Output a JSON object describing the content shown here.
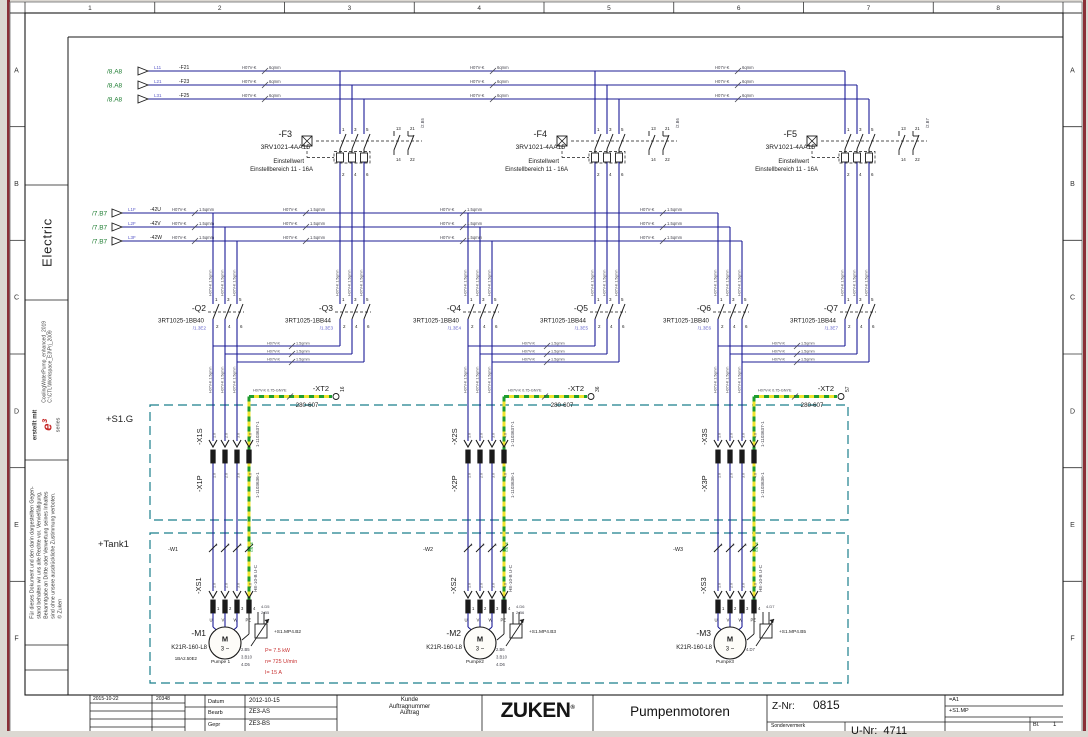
{
  "frame": {
    "columns": [
      "1",
      "2",
      "3",
      "4",
      "5",
      "6",
      "7",
      "8"
    ],
    "rows": [
      "A",
      "B",
      "C",
      "D",
      "E",
      "F"
    ]
  },
  "sidebar": {
    "discipline": "Electric",
    "created_with": "erstellt mit",
    "logo_text": "e³",
    "logo_sub": "series",
    "project_name": "CoolingWaterPump_enhanced_2019",
    "project_path": "C:\\CTL\\Workspace_E3\\Prj_2009",
    "disclaimer_lines": [
      "Für dieses Dokument und den darin dargestellten Gegen-",
      "stand behalten wir uns alle Rechte vor. Vervielfältigung,",
      "Bekanntgabe an Dritte oder Verwertung seines Inhaltes",
      "sind ohne unsere ausdrückliche Zustimmung verboten.",
      "© Zuken"
    ]
  },
  "colors": {
    "wire": "#1c1c96",
    "wire_label": "#44444e",
    "green_ref": "#1e7d32",
    "blue_label": "#5a5ac8",
    "gnye_green": "#1f9d2f",
    "gnye_yellow": "#f0e32e",
    "region": "#1b7f8c",
    "red": "#c83232",
    "black": "#1a1a1a",
    "maroon_edge": "#8a3038"
  },
  "feeders": {
    "lines": [
      {
        "ref": "/8.A8",
        "wire": "L11",
        "device": "-F21",
        "gauge": "H07V-K 6qmm"
      },
      {
        "ref": "/8.A8",
        "wire": "L21",
        "device": "-F23",
        "gauge": "H07V-K 6qmm"
      },
      {
        "ref": "/8.A8",
        "wire": "L31",
        "device": "-F25",
        "gauge": "H07V-K 6qmm"
      }
    ]
  },
  "control_lines": [
    {
      "ref": "/7.B7",
      "wire": "L1F",
      "device": "-42U",
      "gauge": "H07V-K 1.5qmm"
    },
    {
      "ref": "/7.B7",
      "wire": "L2F",
      "device": "-42V",
      "gauge": "H07V-K 1.5qmm"
    },
    {
      "ref": "/7.B7",
      "wire": "L3F",
      "device": "-42W",
      "gauge": "H07V-K 1.5qmm"
    }
  ],
  "regions": [
    {
      "label": "+S1.G"
    },
    {
      "label": "+Tank1"
    }
  ],
  "groups": [
    {
      "breaker": {
        "name": "-F3",
        "type": "3RV1021-4AA15",
        "note1": "Einstellwert",
        "note2": "Einstellbereich 11 - 16A",
        "pins_top": [
          "1",
          "3",
          "5"
        ],
        "pins_bottom": [
          "2",
          "4",
          "6"
        ],
        "aux_pins_top": [
          "13",
          "21"
        ],
        "aux_pins_bottom": [
          "14",
          "22"
        ],
        "aux_ref": "/2.B5"
      },
      "contactor_left": {
        "name": "-Q2",
        "type": "3RT1025-1BB40",
        "ref": "/1.3E2",
        "pins_top": [
          "1",
          "3",
          "5"
        ],
        "pins_bottom": [
          "2",
          "4",
          "6"
        ]
      },
      "contactor_right": {
        "name": "-Q3",
        "type": "3RT1025-1BB44",
        "ref": "/1.3E3",
        "pins_top": [
          "1",
          "3",
          "5"
        ],
        "pins_bottom": [
          "2",
          "4",
          "6"
        ]
      },
      "drop_gauge": "H07V-K 1.5qmm",
      "pe_terminal": {
        "name": "-XT2",
        "pin": "16",
        "part": "280-607",
        "wire_label": "H07V-K 0.75-GNYE"
      },
      "connector_s": {
        "name": "-X1S",
        "part": "1-1103637-1",
        "pins": [
          "1.0",
          "2.0",
          "3.0",
          "4.0"
        ]
      },
      "connector_p": {
        "name": "-X1P",
        "part": "1-1103636-1",
        "pins": [
          "1.0",
          "2.0",
          "3.0",
          "4.0"
        ]
      },
      "cable": {
        "name": "-W1",
        "cores": [
          "1",
          "2",
          "3",
          "GNYE"
        ]
      },
      "socket": {
        "name": "-XS1",
        "type": "HE-10-B U-C",
        "pins": [
          "1",
          "2",
          "3",
          "4"
        ],
        "terminals": [
          "U",
          "V",
          "W",
          "PE"
        ],
        "marks": [
          "1.0",
          "2.0",
          "3.0",
          "4.0"
        ]
      },
      "motor": {
        "name": "-M1",
        "symbol": "M",
        "phase": "3 ~",
        "type": "K21R-160-L8",
        "code": "1BA2.50E2",
        "label": "Pumpe 1",
        "refs": [
          "2.B5",
          "3.B10",
          "4.D5"
        ],
        "specs": [
          "P= 7.5 kW",
          "n= 725 U/min",
          "I= 15 A"
        ]
      },
      "sensor": {
        "name": "+S1.MP4.B2",
        "refs": [
          "4.D5",
          "2.B5"
        ]
      }
    },
    {
      "breaker": {
        "name": "-F4",
        "type": "3RV1021-4AA15",
        "note1": "Einstellwert",
        "note2": "Einstellbereich 11 - 16A",
        "pins_top": [
          "1",
          "3",
          "5"
        ],
        "pins_bottom": [
          "2",
          "4",
          "6"
        ],
        "aux_pins_top": [
          "13",
          "21"
        ],
        "aux_pins_bottom": [
          "14",
          "22"
        ],
        "aux_ref": "/2.B6"
      },
      "contactor_left": {
        "name": "-Q4",
        "type": "3RT1025-1BB40",
        "ref": "/1.3E4",
        "pins_top": [
          "1",
          "3",
          "5"
        ],
        "pins_bottom": [
          "2",
          "4",
          "6"
        ]
      },
      "contactor_right": {
        "name": "-Q5",
        "type": "3RT1025-1BB44",
        "ref": "/1.3E5",
        "pins_top": [
          "1",
          "3",
          "5"
        ],
        "pins_bottom": [
          "2",
          "4",
          "6"
        ]
      },
      "drop_gauge": "H07V-K 1.5qmm",
      "pe_terminal": {
        "name": "-XT2",
        "pin": "36",
        "part": "280-607",
        "wire_label": "H07V-K 0.75-GNYE"
      },
      "connector_s": {
        "name": "-X2S",
        "part": "1-1103637-1",
        "pins": [
          "1.0",
          "2.0",
          "3.0",
          "4.0"
        ]
      },
      "connector_p": {
        "name": "-X2P",
        "part": "1-1103636-1",
        "pins": [
          "1.0",
          "2.0",
          "3.0",
          "4.0"
        ]
      },
      "cable": {
        "name": "-W2",
        "cores": [
          "1",
          "2",
          "3",
          "GNYE"
        ]
      },
      "socket": {
        "name": "-XS2",
        "type": "HE-10-B U-C",
        "pins": [
          "1",
          "2",
          "3",
          "4"
        ],
        "terminals": [
          "U",
          "V",
          "W",
          "PE"
        ],
        "marks": [
          "1.0",
          "2.0",
          "3.0",
          "4.0"
        ]
      },
      "motor": {
        "name": "-M2",
        "symbol": "M",
        "phase": "3 ~",
        "type": "K21R-160-L8",
        "label": "Pumpe2",
        "refs": [
          "2.B6",
          "3.B10",
          "4.D6"
        ]
      },
      "sensor": {
        "name": "+S1.MP4.B3",
        "refs": [
          "4.D6",
          "2.B6"
        ]
      }
    },
    {
      "breaker": {
        "name": "-F5",
        "type": "3RV1021-4AA15",
        "note1": "Einstellwert",
        "note2": "Einstellbereich 11 - 16A",
        "pins_top": [
          "1",
          "3",
          "5"
        ],
        "pins_bottom": [
          "2",
          "4",
          "6"
        ],
        "aux_pins_top": [
          "13",
          "21"
        ],
        "aux_pins_bottom": [
          "14",
          "22"
        ],
        "aux_ref": "/2.B7"
      },
      "contactor_left": {
        "name": "-Q6",
        "type": "3RT1025-1BB40",
        "ref": "/1.3E6",
        "pins_top": [
          "1",
          "3",
          "5"
        ],
        "pins_bottom": [
          "2",
          "4",
          "6"
        ]
      },
      "contactor_right": {
        "name": "-Q7",
        "type": "3RT1025-1BB44",
        "ref": "/1.3E7",
        "pins_top": [
          "1",
          "3",
          "5"
        ],
        "pins_bottom": [
          "2",
          "4",
          "6"
        ]
      },
      "drop_gauge": "H07V-K 1.5qmm",
      "pe_terminal": {
        "name": "-XT2",
        "pin": "57",
        "part": "280-607",
        "wire_label": "H07V-K 0.75-GNYE"
      },
      "connector_s": {
        "name": "-X3S",
        "part": "1-1103637-1",
        "pins": [
          "1.0",
          "2.0",
          "3.0",
          "4.0"
        ]
      },
      "connector_p": {
        "name": "-X3P",
        "part": "1-1103636-1",
        "pins": [
          "1.0",
          "2.0",
          "3.0",
          "4.0"
        ]
      },
      "cable": {
        "name": "-W3",
        "cores": [
          "1",
          "2",
          "3",
          "GNYE"
        ]
      },
      "socket": {
        "name": "-XS3",
        "type": "HE-10-B U-C",
        "pins": [
          "1",
          "2",
          "3",
          "4"
        ],
        "terminals": [
          "U",
          "V",
          "W",
          "PE"
        ],
        "marks": [
          "1.0",
          "2.0",
          "3.0",
          "4.0"
        ]
      },
      "motor": {
        "name": "-M3",
        "symbol": "M",
        "phase": "3 ~",
        "type": "K21R-160-L8",
        "label": "Pumpe3",
        "refs": [
          "4.D7"
        ]
      },
      "sensor": {
        "name": "+S1.MP4.B5",
        "refs": [
          "4.D7"
        ]
      }
    }
  ],
  "title_block": {
    "rev_date": "2015-10-22",
    "rev_num": "20348",
    "date_label": "Datum",
    "date": "2012-10-15",
    "bearb_label": "Bearb",
    "bearb": "ZE3-AS",
    "gepr_label": "Gepr",
    "gepr": "ZE3-BS",
    "customer_lines": [
      "Kunde",
      "Auftragnummer",
      "Auftrag"
    ],
    "logo": "ZUKEN",
    "logo_reg": "®",
    "title": "Pumpenmotoren",
    "znr_label": "Z-Nr:",
    "znr": "0815",
    "sondervermerk": "Sondervermerk",
    "unr_label": "U-Nr:",
    "unr": "4711",
    "loc1": "=A1",
    "loc2": "+S1.MP",
    "sheet_label": "Bl.",
    "sheet": "1"
  }
}
